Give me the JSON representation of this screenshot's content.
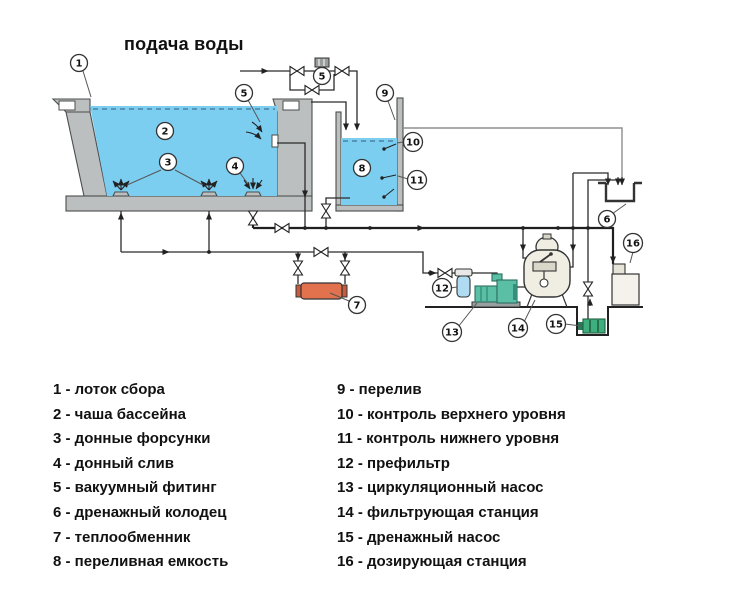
{
  "title": "подача воды",
  "callouts": {
    "n1": "1",
    "n2": "2",
    "n3": "3",
    "n4": "4",
    "n5": "5",
    "n6": "6",
    "n7": "7",
    "n8": "8",
    "n9": "9",
    "n10": "10",
    "n11": "11",
    "n12": "12",
    "n13": "13",
    "n14": "14",
    "n15": "15",
    "n16": "16",
    "fill_valve": "5"
  },
  "legend": {
    "left": [
      "1 - лоток сбора",
      "2 - чаша бассейна",
      "3 - донные форсунки",
      "4 - донный слив",
      "5 - вакуумный фитинг",
      "6 - дренажный колодец",
      "7 - теплообменник",
      "8 - переливная емкость"
    ],
    "right": [
      "9 - перелив",
      "10 - контроль верхнего уровня",
      "11 - контроль нижнего уровня",
      "12 - префильтр",
      "13 - циркуляционный насос",
      "14 - фильтрующая станция",
      "15 - дренажный насос",
      "16 - дозирующая станция"
    ]
  },
  "colors": {
    "water": "#7CCEF0",
    "heat_exchanger": "#E2714E",
    "pump": "#5BBFA6",
    "drain_pump": "#3FAE7E",
    "filter_tank": "#F0EEE3",
    "prefilter": "#AFDCF2",
    "dosing_station": "#F4F2EA"
  }
}
